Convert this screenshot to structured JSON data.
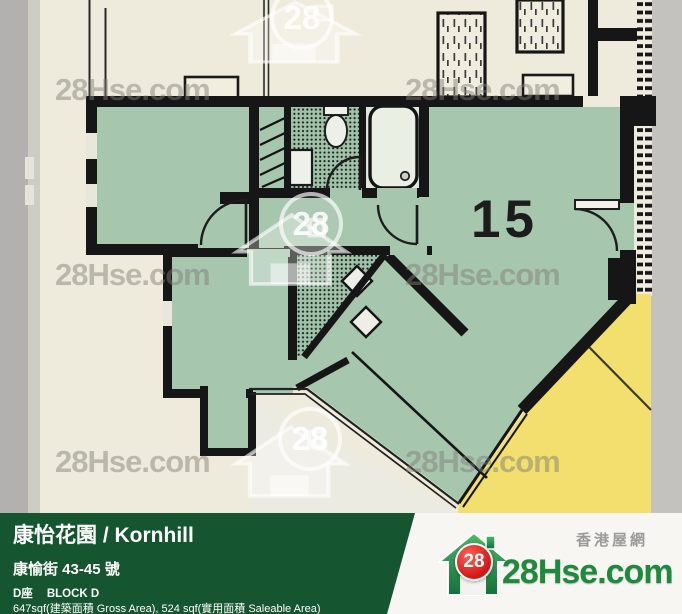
{
  "plan": {
    "unit_number": "15",
    "colors": {
      "room_green": "#a7c6ae",
      "adjacent_unit_yellow": "#f2df6e",
      "background_cream": "#efebdc",
      "wall_black": "#1a1a1a",
      "side_strip_grey": "#b2b1af"
    }
  },
  "watermark": {
    "text": "28Hse.com",
    "number": "28"
  },
  "footer": {
    "title": "康怡花園 / Kornhill",
    "address": "康愉街 43-45 號",
    "block_cn": "D座",
    "block_en": "BLOCK D",
    "area_info": "647sqf(建築面積 Gross Area), 524 sqf(實用面積 Saleable Area)",
    "bar_color": "#15552f"
  },
  "brand": {
    "site_name": "28Hse.com",
    "site_name_cn": "香港屋網",
    "logo_number": "28",
    "logo_green": "#1d8a3c",
    "logo_red": "#d21717"
  }
}
